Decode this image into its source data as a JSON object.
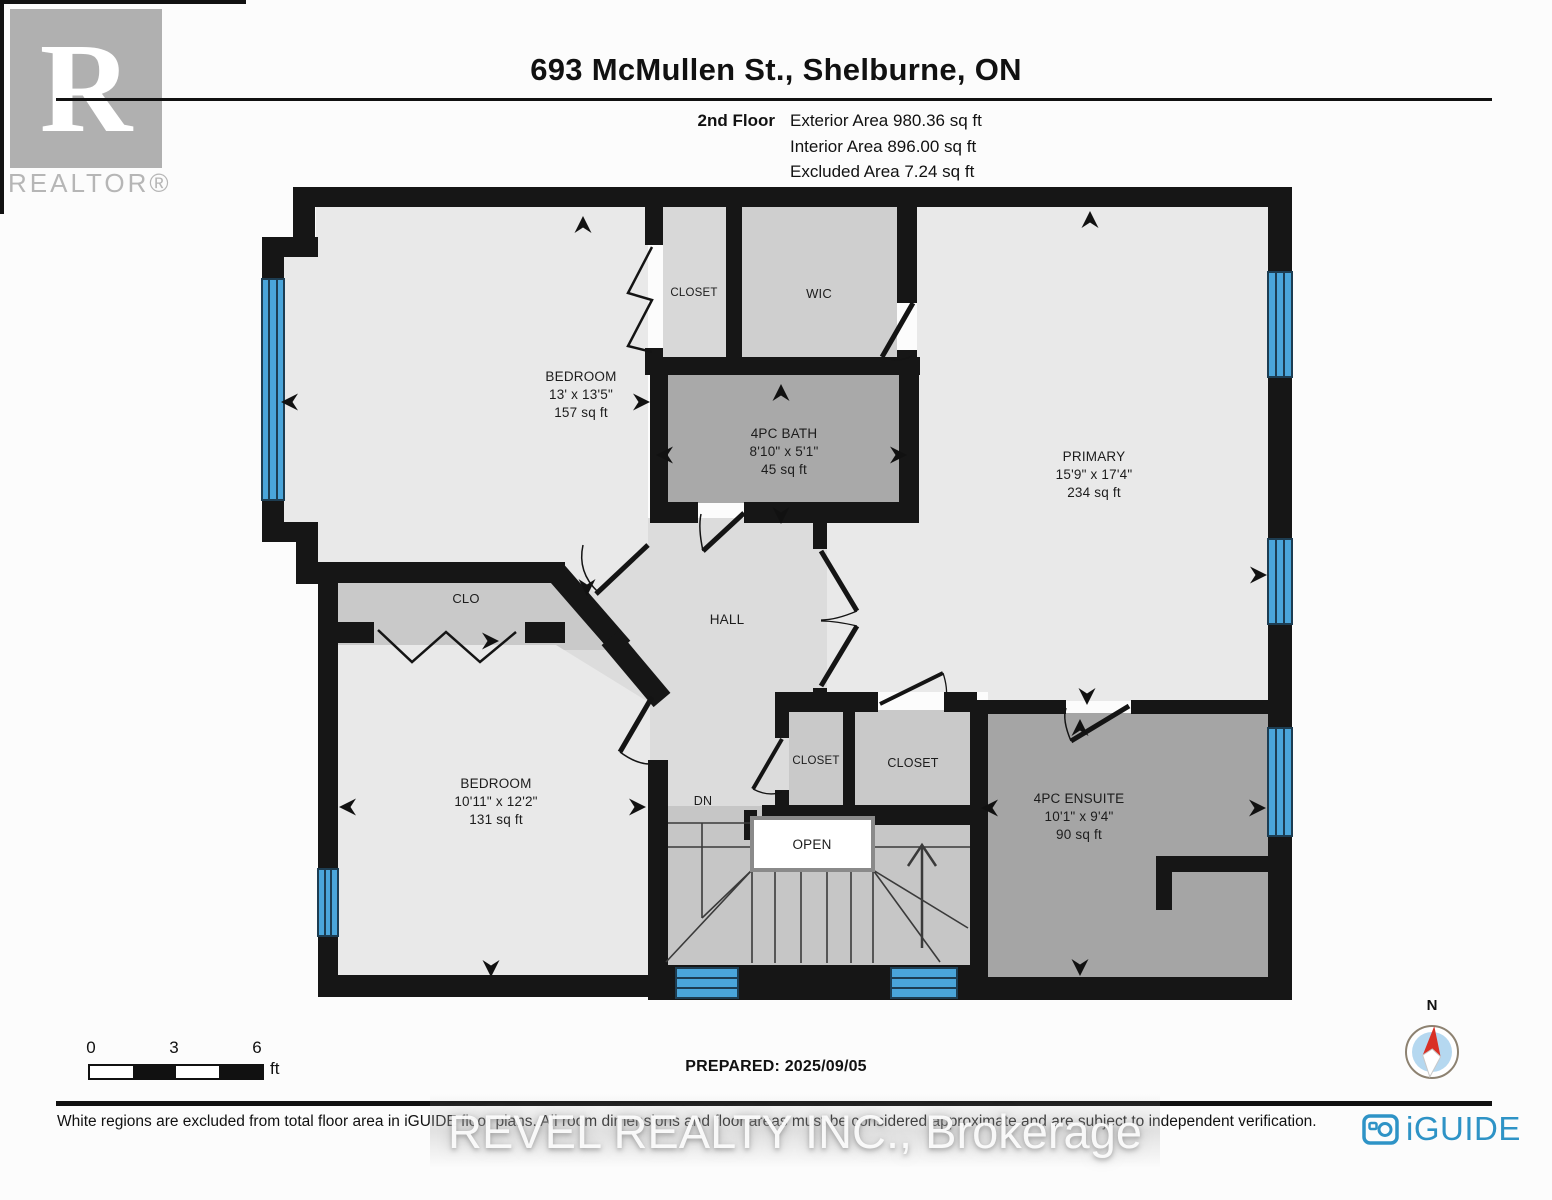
{
  "header": {
    "title": "693 McMullen St., Shelburne, ON",
    "floor_label": "2nd Floor",
    "area_lines": [
      "Exterior Area 980.36 sq ft",
      "Interior Area 896.00 sq ft",
      "Excluded Area 7.24 sq ft"
    ],
    "realtor": {
      "letter": "R",
      "wordmark": "REALTOR®"
    }
  },
  "floorplan": {
    "rooms": [
      {
        "name": "BEDROOM",
        "dims": "13' x 13'5\"",
        "area": "157 sq ft"
      },
      {
        "name": "CLOSET"
      },
      {
        "name": "WIC"
      },
      {
        "name": "4PC BATH",
        "dims": "8'10\" x 5'1\"",
        "area": "45 sq ft"
      },
      {
        "name": "PRIMARY",
        "dims": "15'9\" x 17'4\"",
        "area": "234 sq ft"
      },
      {
        "name": "CLO"
      },
      {
        "name": "HALL"
      },
      {
        "name": "BEDROOM",
        "dims": "10'11\" x 12'2\"",
        "area": "131 sq ft"
      },
      {
        "name": "CLOSET"
      },
      {
        "name": "CLOSET"
      },
      {
        "name": "4PC ENSUITE",
        "dims": "10'1\" x 9'4\"",
        "area": "90 sq ft"
      }
    ],
    "labels": {
      "open": "OPEN",
      "down": "DN"
    },
    "compass": {
      "north": "N"
    }
  },
  "footer": {
    "scale": {
      "ticks": [
        "0",
        "3",
        "6"
      ],
      "unit": "ft"
    },
    "prepared": "PREPARED: 2025/09/05",
    "disclaimer": "White regions are excluded from total floor area in iGUIDE floor plans. All room dimensions and floor areas must be considered approximate and are subject to independent verification.",
    "brand": "iGUIDE",
    "watermark": "REVEL REALTY INC., Brokerage"
  },
  "colors": {
    "window_blue": "#4aa5da",
    "wall_black": "#161616",
    "brand_blue": "#2e93c6",
    "compass_red": "#d93025"
  }
}
